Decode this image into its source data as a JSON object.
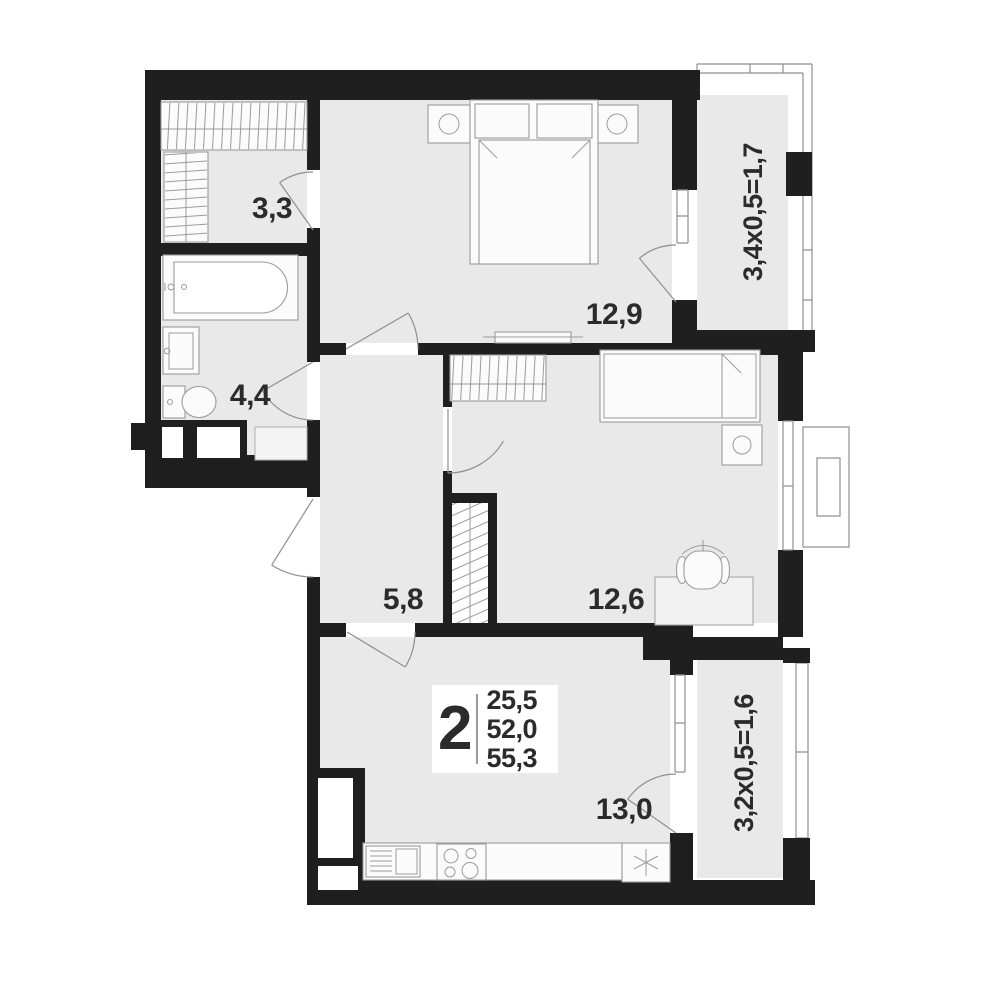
{
  "plan": {
    "room_labels": {
      "wardrobe": "3,3",
      "bathroom": "4,4",
      "bedroom": "12,9",
      "hallway": "5,8",
      "bedroom2": "12,6",
      "kitchen_living": "13,0"
    },
    "balcony_labels": {
      "top": "3,4х0,5=1,7",
      "bottom": "3,2х0,5=1,6"
    },
    "info_box": {
      "rooms_count": "2",
      "areas": [
        "25,5",
        "52,0",
        "55,3"
      ]
    },
    "colors": {
      "wall": "#1f1f1f",
      "floor": "#e9e9e9",
      "fixture_line": "#8f8f8f",
      "label": "#2b2b2b"
    }
  }
}
